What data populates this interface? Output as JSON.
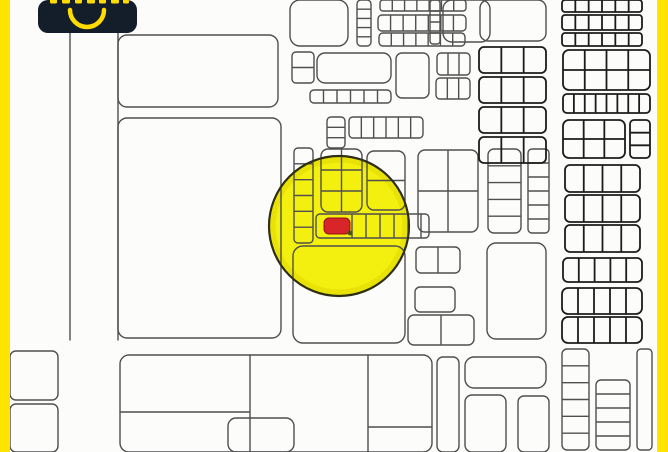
{
  "meta": {
    "width": 668,
    "height": 452,
    "kind": "cadastral parcel map with highlighted lot"
  },
  "colors": {
    "map_bg": "#fcfcfa",
    "frame_yellow": "#FFE402",
    "line_light": "#4f4f4f",
    "line_dark": "#1c1c1c",
    "circle_fill": "#F3EF0E",
    "circle_rim": "#E0D700",
    "circle_outline": "#2e2e18",
    "marker_red": "#D8252A",
    "marker_outline": "#8F1216",
    "marker_dot": "#465212",
    "badge_bg": "#141E2B",
    "badge_yellow": "#FFDC00"
  },
  "frame": {
    "left_bar": {
      "x": 0,
      "w": 10
    },
    "right_bar": {
      "x": 657,
      "w": 11
    }
  },
  "badge": {
    "x": 38,
    "y": 0,
    "w": 99,
    "h": 33,
    "radius": 10,
    "smile_arc": {
      "x1": 32,
      "y1": 10,
      "r": 17,
      "x2": 66,
      "y2": 10,
      "stroke_w": 4.5
    },
    "cropped_glyph_marks": [
      [
        12,
        7
      ],
      [
        24,
        8
      ],
      [
        37,
        7
      ],
      [
        49,
        8
      ],
      [
        61,
        7
      ],
      [
        73,
        8
      ],
      [
        85,
        6
      ]
    ],
    "glyph_mark_h": 5
  },
  "highlight": {
    "circle": {
      "cx": 339,
      "cy": 226,
      "r": 70
    },
    "marker": {
      "x": 324,
      "y": 218,
      "w": 26,
      "h": 16,
      "rx": 5
    },
    "dot": {
      "cx": 350,
      "cy": 233,
      "r": 2.4
    }
  },
  "map": {
    "stroke_w_light": 1.4,
    "stroke_w_dark": 1.8,
    "parcels_xywh_rx_cols_rows_cls": [
      [
        118,
        35,
        160,
        72,
        9,
        0,
        0,
        0
      ],
      [
        118,
        118,
        163,
        220,
        9,
        0,
        0,
        0
      ],
      [
        10,
        351,
        48,
        49,
        6,
        0,
        0,
        0
      ],
      [
        10,
        404,
        48,
        48,
        6,
        0,
        0,
        0
      ],
      [
        290,
        0,
        58,
        46,
        10,
        0,
        0,
        0
      ],
      [
        357,
        0,
        14,
        46,
        4,
        0,
        4,
        0
      ],
      [
        380,
        0,
        86,
        11,
        3,
        6,
        0,
        0
      ],
      [
        378,
        15,
        88,
        16,
        4,
        6,
        0,
        0
      ],
      [
        379,
        33,
        86,
        13,
        4,
        6,
        0,
        0
      ],
      [
        292,
        52,
        22,
        31,
        4,
        0,
        1,
        0
      ],
      [
        317,
        53,
        74,
        30,
        8,
        0,
        0,
        0
      ],
      [
        310,
        90,
        81,
        13,
        4,
        5,
        0,
        0
      ],
      [
        396,
        53,
        33,
        45,
        6,
        0,
        0,
        0
      ],
      [
        437,
        53,
        33,
        22,
        4,
        2,
        0,
        0
      ],
      [
        436,
        78,
        34,
        21,
        4,
        2,
        0,
        0
      ],
      [
        327,
        117,
        18,
        31,
        4,
        0,
        2,
        0
      ],
      [
        349,
        117,
        74,
        21,
        4,
        5,
        0,
        0
      ],
      [
        430,
        0,
        10,
        44,
        3,
        0,
        3,
        0
      ],
      [
        443,
        0,
        47,
        42,
        9,
        0,
        0,
        0
      ],
      [
        294,
        148,
        19,
        95,
        4,
        0,
        5,
        0
      ],
      [
        321,
        149,
        41,
        63,
        7,
        1,
        2,
        0
      ],
      [
        367,
        151,
        38,
        59,
        7,
        0,
        1,
        0
      ],
      [
        316,
        214,
        113,
        24,
        4,
        0,
        0,
        0
      ],
      [
        293,
        246,
        112,
        97,
        10,
        0,
        0,
        0
      ],
      [
        418,
        150,
        60,
        82,
        7,
        1,
        1,
        0
      ],
      [
        488,
        149,
        33,
        84,
        6,
        0,
        4,
        0
      ],
      [
        528,
        149,
        21,
        84,
        4,
        0,
        5,
        0
      ],
      [
        416,
        247,
        44,
        26,
        5,
        1,
        0,
        0
      ],
      [
        415,
        287,
        40,
        25,
        5,
        0,
        0,
        0
      ],
      [
        408,
        315,
        66,
        30,
        6,
        1,
        0,
        0
      ],
      [
        487,
        243,
        59,
        96,
        9,
        0,
        0,
        0
      ],
      [
        480,
        0,
        66,
        41,
        8,
        0,
        0,
        0
      ],
      [
        479,
        47,
        67,
        26,
        5,
        2,
        0,
        1
      ],
      [
        479,
        77,
        67,
        26,
        5,
        2,
        0,
        1
      ],
      [
        479,
        107,
        67,
        26,
        5,
        2,
        0,
        1
      ],
      [
        479,
        137,
        67,
        26,
        5,
        2,
        0,
        1
      ],
      [
        562,
        0,
        80,
        12,
        3,
        5,
        0,
        1
      ],
      [
        562,
        15,
        80,
        15,
        3,
        5,
        0,
        1
      ],
      [
        562,
        33,
        80,
        13,
        3,
        5,
        0,
        1
      ],
      [
        563,
        50,
        87,
        40,
        6,
        3,
        1,
        1
      ],
      [
        563,
        94,
        87,
        19,
        4,
        7,
        0,
        1
      ],
      [
        563,
        120,
        62,
        38,
        6,
        2,
        1,
        1
      ],
      [
        630,
        120,
        20,
        38,
        4,
        0,
        2,
        1
      ],
      [
        565,
        165,
        75,
        27,
        5,
        3,
        0,
        1
      ],
      [
        565,
        195,
        75,
        27,
        5,
        3,
        0,
        1
      ],
      [
        565,
        225,
        75,
        27,
        5,
        3,
        0,
        1
      ],
      [
        563,
        258,
        79,
        24,
        5,
        4,
        0,
        1
      ],
      [
        562,
        288,
        80,
        26,
        6,
        4,
        0,
        1
      ],
      [
        562,
        317,
        80,
        26,
        6,
        4,
        0,
        1
      ],
      [
        562,
        349,
        27,
        101,
        5,
        0,
        5,
        0
      ],
      [
        596,
        380,
        34,
        70,
        5,
        0,
        4,
        0
      ],
      [
        637,
        349,
        15,
        101,
        4,
        0,
        0,
        0
      ],
      [
        120,
        355,
        312,
        97,
        9,
        0,
        0,
        0
      ],
      [
        228,
        418,
        66,
        34,
        8,
        0,
        0,
        0
      ],
      [
        437,
        357,
        22,
        95,
        6,
        0,
        0,
        0
      ],
      [
        465,
        357,
        81,
        31,
        9,
        0,
        0,
        0
      ],
      [
        465,
        395,
        41,
        57,
        7,
        0,
        0,
        0
      ],
      [
        518,
        396,
        31,
        56,
        6,
        0,
        0,
        0
      ]
    ],
    "lines_x1y1x2y2_cls": [
      [
        70,
        33,
        70,
        340,
        0
      ],
      [
        118,
        33,
        118,
        340,
        0
      ],
      [
        250,
        355,
        250,
        452,
        0
      ],
      [
        368,
        355,
        368,
        452,
        0
      ],
      [
        120,
        412,
        250,
        412,
        0
      ],
      [
        368,
        427,
        432,
        427,
        0
      ],
      [
        352,
        215,
        352,
        237,
        0
      ],
      [
        366,
        215,
        366,
        237,
        0
      ],
      [
        380,
        215,
        380,
        237,
        0
      ],
      [
        394,
        215,
        394,
        237,
        0
      ],
      [
        408,
        215,
        408,
        237,
        0
      ],
      [
        421,
        215,
        421,
        237,
        0
      ]
    ]
  }
}
